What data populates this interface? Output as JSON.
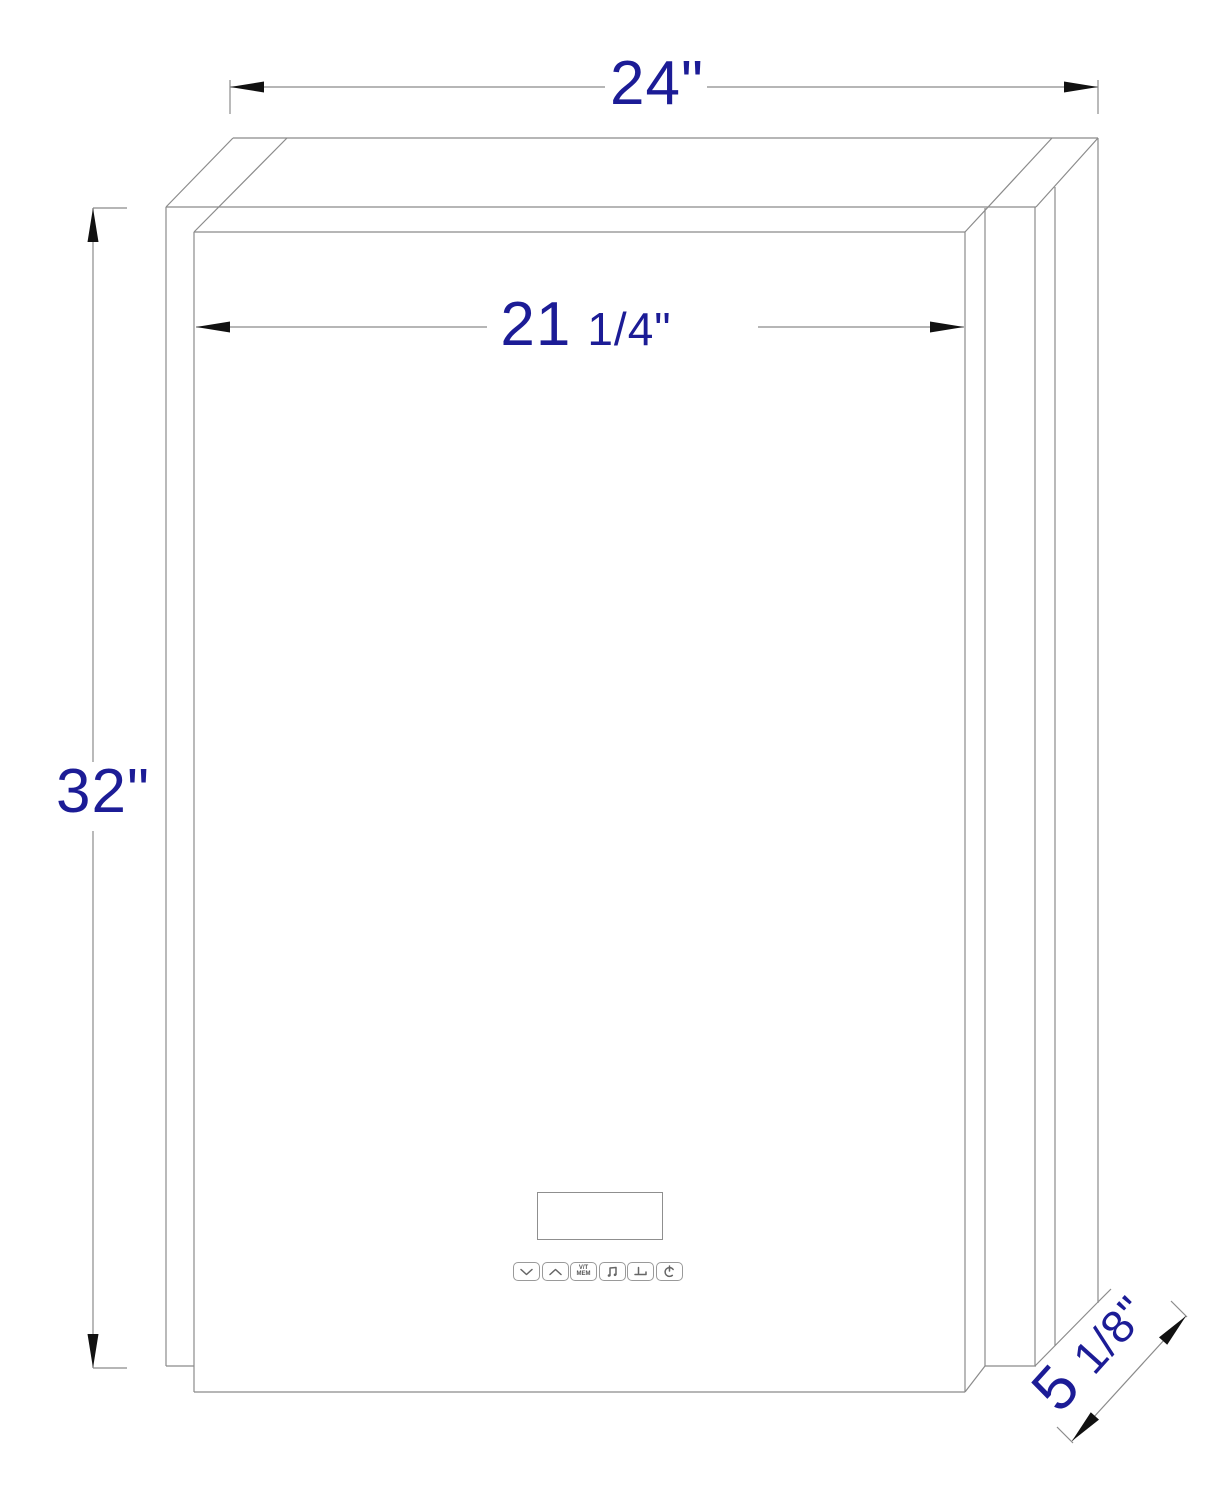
{
  "drawing": {
    "type": "technical-dimension-diagram",
    "subject": "wall-mounted mirrored cabinet, front oblique view",
    "colors": {
      "background": "#ffffff",
      "line": "#8b8b8b",
      "arrow": "#111111",
      "dimension_text": "#1c1c96"
    },
    "dimensions": {
      "overall_width": {
        "label": "24\""
      },
      "face_width": {
        "main": "21",
        "fraction": "1/4\""
      },
      "height": {
        "label": "32\""
      },
      "depth": {
        "main": "5",
        "fraction": "1/8\""
      }
    },
    "control_panel": {
      "display": {
        "name": "lcd-display"
      },
      "buttons": [
        {
          "name": "chevron-down"
        },
        {
          "name": "chevron-up"
        },
        {
          "name": "vt-mem",
          "text_top": "V/T",
          "text_bottom": "MEM"
        },
        {
          "name": "music-note"
        },
        {
          "name": "defogger"
        },
        {
          "name": "power"
        }
      ]
    }
  }
}
